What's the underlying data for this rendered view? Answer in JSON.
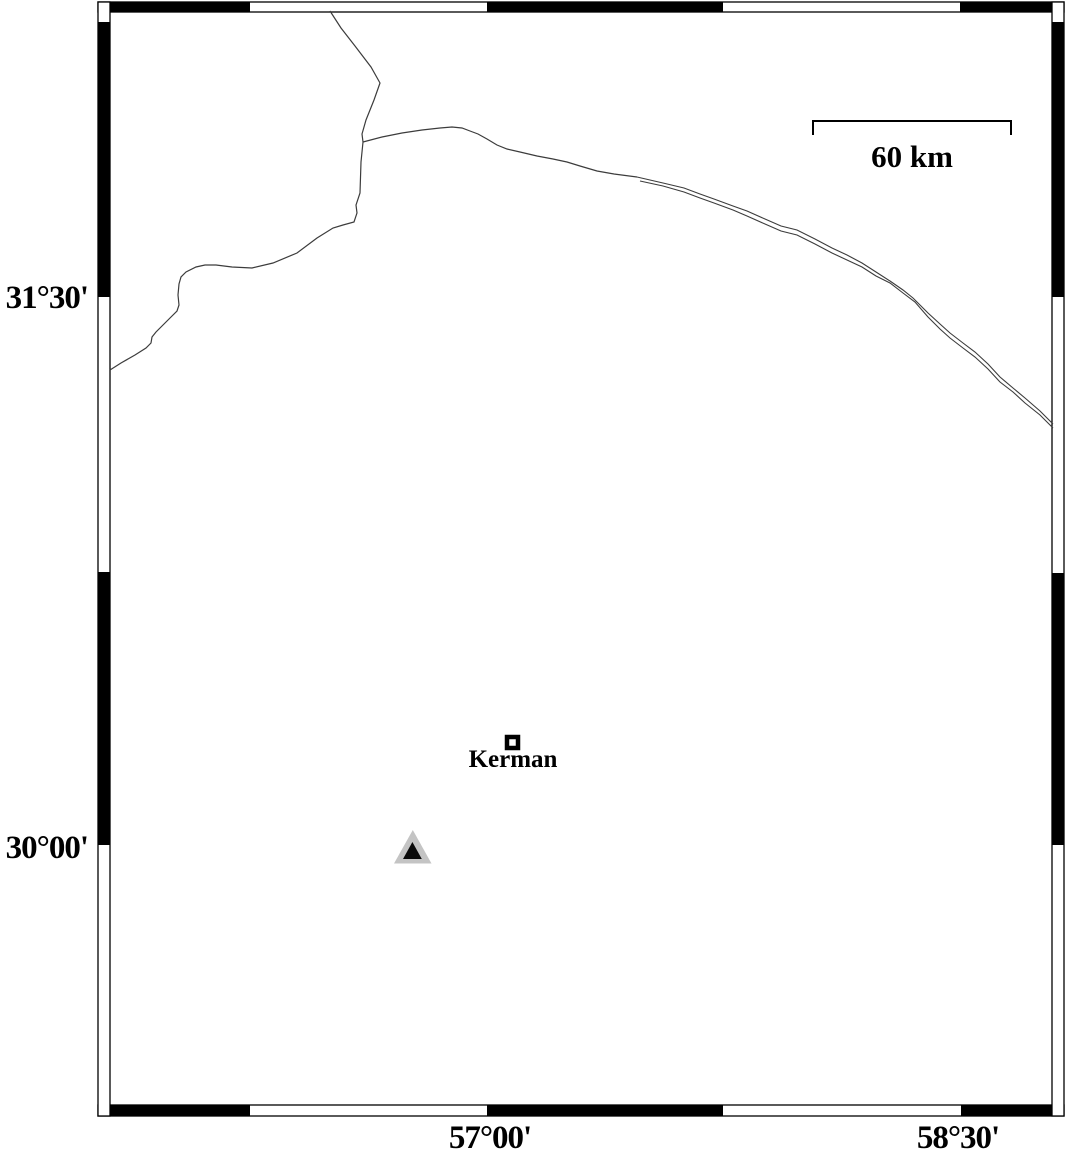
{
  "map": {
    "axis_labels": {
      "lat_upper": "31°30'",
      "lat_lower": "30°00'",
      "lon_left": "57°00'",
      "lon_right": "58°30'"
    },
    "scale_bar": {
      "label": "60 km"
    },
    "markers": {
      "city": {
        "label": "Kerman",
        "icon": "square-city-marker-icon"
      },
      "station": {
        "icon": "triangle-station-marker-icon"
      }
    },
    "colors": {
      "background": "#ffffff",
      "frame_black": "#000000",
      "boundary_line": "#3c3c3c",
      "triangle_gray": "#c4c4c4",
      "triangle_core": "#0a0a0a"
    }
  }
}
